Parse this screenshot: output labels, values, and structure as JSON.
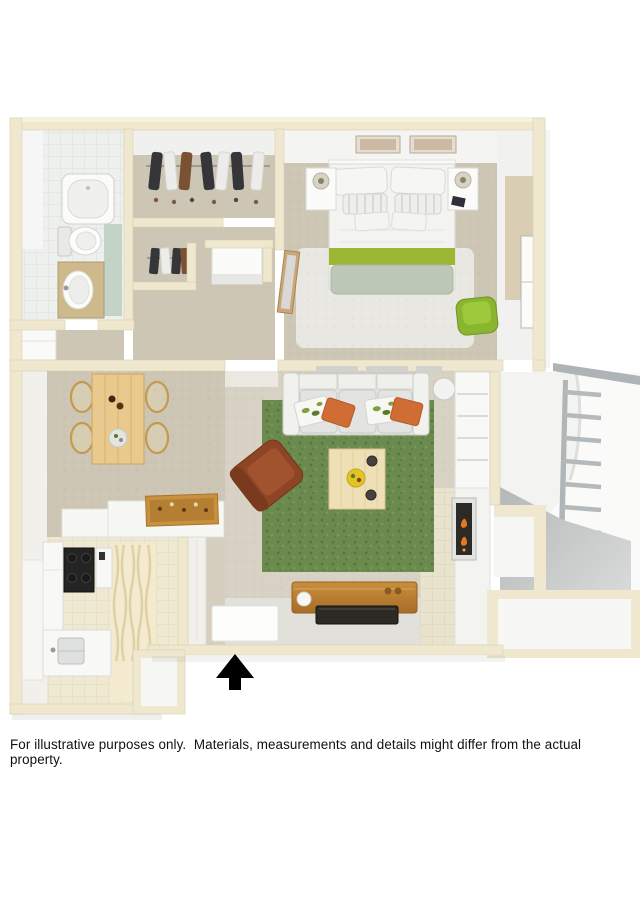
{
  "disclaimer": "For illustrative purposes only.  Materials, measurements and details might differ from the actual property.",
  "icons": {
    "north_arrow": "▲"
  },
  "colors": {
    "text": "#111111",
    "wall": "#efe8cf",
    "wall_hi": "#f7f2de",
    "wall_edge": "#d8d0b4",
    "carpet": "#cec6b4",
    "carpet_light": "#d6cfc0",
    "bedroom_rug": "#e9e7e2",
    "living_floor": "#d7d2c4",
    "tile_kitchen": "#f0e9d2",
    "bath_floor": "#eef0ee",
    "bath_accent": "#c3d3c8",
    "rug_green": "#6b8a4e",
    "sofa": "#e6e6e4",
    "white_furniture": "#fbfbfa",
    "wood_light": "#e9c98d",
    "wood_mid": "#c8913f",
    "leather": "#8e4526",
    "orange": "#cf6d35",
    "chair_green": "#8ab52e",
    "bed_green": "#9cb733",
    "sage": "#bdc7b8",
    "dark": "#2d2a26",
    "gray_rail": "#aeb3b5",
    "balcony_floor": "#c6cac9",
    "flame": "#e07a22",
    "black": "#000000"
  }
}
